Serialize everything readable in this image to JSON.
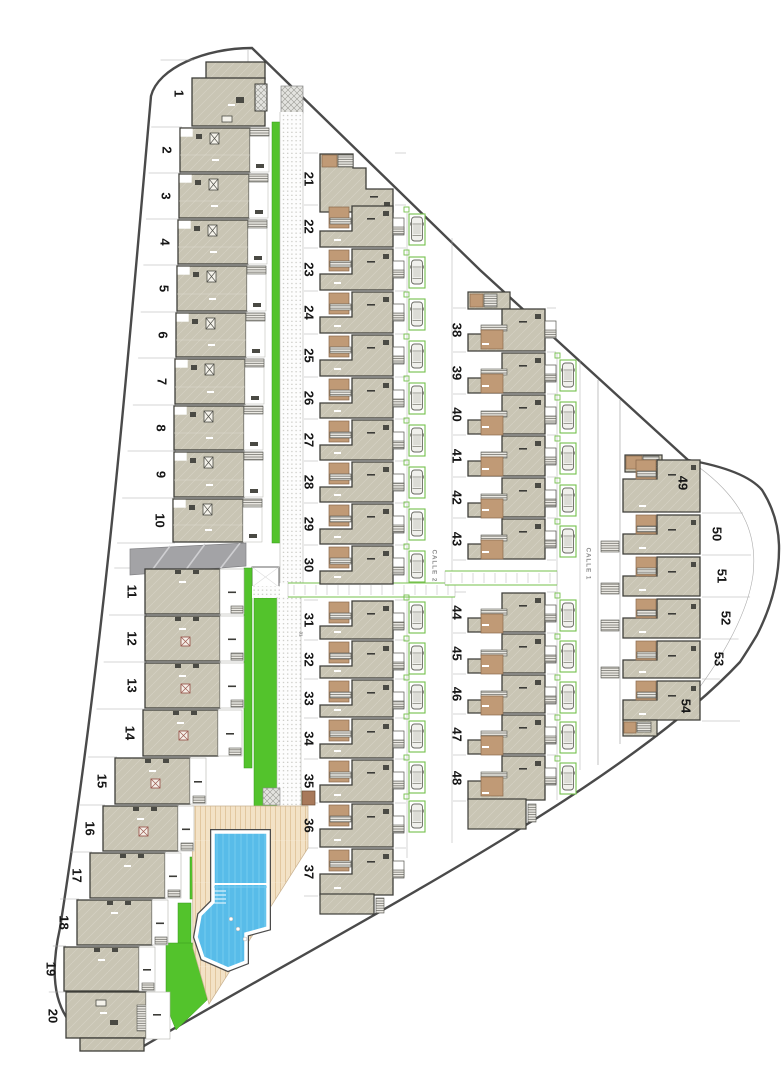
{
  "plan": {
    "title": "residential site plan",
    "streets": [
      {
        "id": "calle-2",
        "label": "CALLE 2",
        "x": 434,
        "y": 566
      },
      {
        "id": "calle-1",
        "label": "CALLE 1",
        "x": 588,
        "y": 564
      }
    ],
    "annotation_small": {
      "label": "31",
      "x": 301,
      "y": 634
    },
    "columns": {
      "col1_top": {
        "style": "A",
        "plots": [
          {
            "n": 1,
            "y": 60,
            "h": 67,
            "x": 192
          },
          {
            "n": 2,
            "y": 127,
            "h": 46,
            "x": 180
          },
          {
            "n": 3,
            "y": 173,
            "h": 46,
            "x": 179
          },
          {
            "n": 4,
            "y": 219,
            "h": 46,
            "x": 178
          },
          {
            "n": 5,
            "y": 265,
            "h": 47,
            "x": 177
          },
          {
            "n": 6,
            "y": 312,
            "h": 46,
            "x": 176
          },
          {
            "n": 7,
            "y": 358,
            "h": 47,
            "x": 175
          },
          {
            "n": 8,
            "y": 405,
            "h": 46,
            "x": 174
          },
          {
            "n": 9,
            "y": 451,
            "h": 47,
            "x": 174
          },
          {
            "n": 10,
            "y": 498,
            "h": 45,
            "x": 173
          }
        ]
      },
      "col1_bottom": {
        "style": "B",
        "plots": [
          {
            "n": 11,
            "y": 568,
            "h": 47,
            "x": 145
          },
          {
            "n": 12,
            "y": 615,
            "h": 47,
            "x": 145
          },
          {
            "n": 13,
            "y": 662,
            "h": 47,
            "x": 145
          },
          {
            "n": 14,
            "y": 709,
            "h": 48,
            "x": 143
          },
          {
            "n": 15,
            "y": 757,
            "h": 48,
            "x": 115
          },
          {
            "n": 16,
            "y": 805,
            "h": 47,
            "x": 103
          },
          {
            "n": 17,
            "y": 852,
            "h": 47,
            "x": 90
          },
          {
            "n": 18,
            "y": 899,
            "h": 47,
            "x": 77
          },
          {
            "n": 19,
            "y": 946,
            "h": 46,
            "x": 64
          },
          {
            "n": 20,
            "y": 992,
            "h": 48,
            "x": 66
          }
        ]
      },
      "col2_top": {
        "style": "C",
        "x": 320,
        "w": 73,
        "numX": 309,
        "plots": [
          {
            "n": 21,
            "y": 153,
            "h": 52,
            "end": "top"
          },
          {
            "n": 22,
            "y": 205,
            "h": 43
          },
          {
            "n": 23,
            "y": 248,
            "h": 43
          },
          {
            "n": 24,
            "y": 291,
            "h": 43
          },
          {
            "n": 25,
            "y": 334,
            "h": 43
          },
          {
            "n": 26,
            "y": 377,
            "h": 42
          },
          {
            "n": 27,
            "y": 419,
            "h": 42
          },
          {
            "n": 28,
            "y": 461,
            "h": 42
          },
          {
            "n": 29,
            "y": 503,
            "h": 42
          },
          {
            "n": 30,
            "y": 545,
            "h": 40
          }
        ]
      },
      "col2_bottom": {
        "style": "C",
        "x": 320,
        "w": 73,
        "numX": 309,
        "plots": [
          {
            "n": 31,
            "y": 600,
            "h": 40
          },
          {
            "n": 32,
            "y": 640,
            "h": 39
          },
          {
            "n": 33,
            "y": 679,
            "h": 39
          },
          {
            "n": 34,
            "y": 718,
            "h": 41
          },
          {
            "n": 35,
            "y": 759,
            "h": 44
          },
          {
            "n": 36,
            "y": 803,
            "h": 45
          },
          {
            "n": 37,
            "y": 848,
            "h": 48,
            "end": "bottom"
          }
        ]
      },
      "col3_top": {
        "style": "C",
        "x": 468,
        "w": 77,
        "numX": 457,
        "plots": [
          {
            "n": 38,
            "y": 308,
            "h": 44,
            "end": "top"
          },
          {
            "n": 39,
            "y": 352,
            "h": 42
          },
          {
            "n": 40,
            "y": 394,
            "h": 41
          },
          {
            "n": 41,
            "y": 435,
            "h": 42
          },
          {
            "n": 42,
            "y": 477,
            "h": 41
          },
          {
            "n": 43,
            "y": 518,
            "h": 42
          }
        ]
      },
      "col3_bottom": {
        "style": "C",
        "x": 468,
        "w": 77,
        "numX": 457,
        "plots": [
          {
            "n": 44,
            "y": 592,
            "h": 41
          },
          {
            "n": 45,
            "y": 633,
            "h": 41
          },
          {
            "n": 46,
            "y": 674,
            "h": 40
          },
          {
            "n": 47,
            "y": 714,
            "h": 41
          },
          {
            "n": 48,
            "y": 755,
            "h": 46,
            "end": "bottom"
          }
        ]
      },
      "col4": {
        "style": "D",
        "x": 623,
        "w": 77,
        "plots": [
          {
            "n": 49,
            "y": 458,
            "h": 55,
            "numX": 683,
            "numY": 483,
            "end": "top"
          },
          {
            "n": 50,
            "y": 513,
            "h": 42,
            "numX": 717
          },
          {
            "n": 51,
            "y": 555,
            "h": 42,
            "numX": 722
          },
          {
            "n": 52,
            "y": 597,
            "h": 42,
            "numX": 726
          },
          {
            "n": 53,
            "y": 639,
            "h": 40,
            "numX": 719
          },
          {
            "n": 54,
            "y": 679,
            "h": 42,
            "numX": 686,
            "numY": 706,
            "end": "bottom"
          }
        ]
      }
    },
    "parking": {
      "calle2": {
        "x": 409,
        "bays": [
          214,
          257,
          299,
          341,
          383,
          425,
          467,
          509,
          551,
          602,
          643,
          682,
          721,
          762,
          801
        ]
      },
      "calle1": {
        "x": 560,
        "bays": [
          360,
          402,
          443,
          485,
          526,
          600,
          641,
          682,
          722,
          763
        ]
      }
    },
    "colors": {
      "boundary": "#4a4a4a",
      "line": "#ababab",
      "house_fill": "#c9c5b4",
      "house_edge": "#3e3e39",
      "brown": "#c09a76",
      "brown_edge": "#8a6a4c",
      "green": "#53c32c",
      "green_edge": "#36991a",
      "parking_green": "#74c04b",
      "pool_blue": "#58bce9",
      "pool_line": "#79cdf1",
      "deck": "#f3e2c6",
      "deck_line": "#e2c79f",
      "driveway": "#a3a3a6",
      "stair_bg": "#eceae4",
      "stair_line": "#60605a",
      "number": "#161616",
      "street_text": "#8a8a8a"
    }
  }
}
